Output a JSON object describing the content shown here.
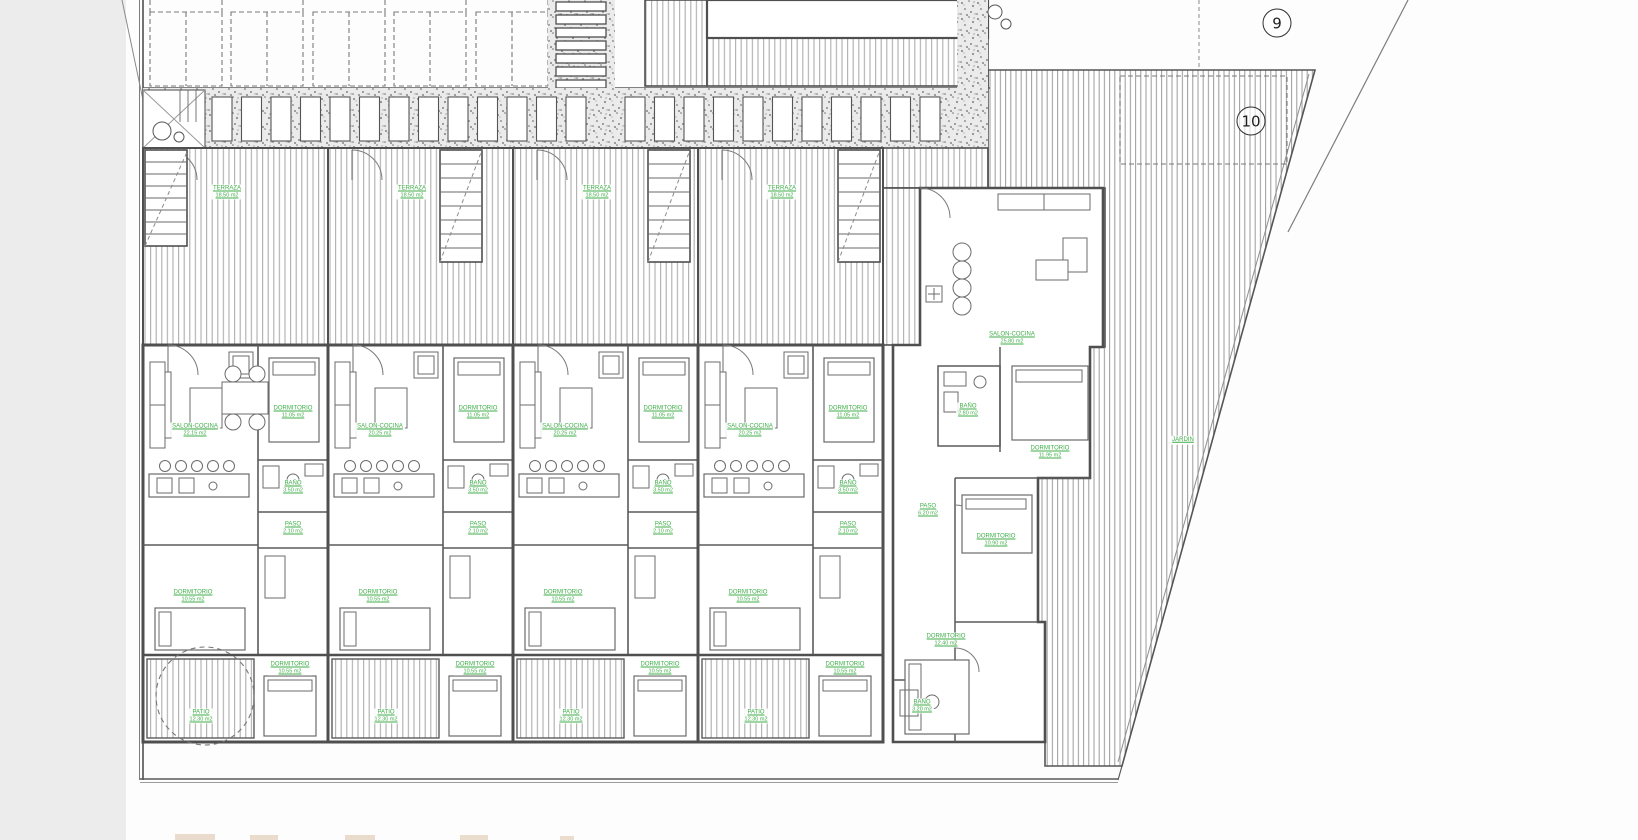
{
  "markers": {
    "nine": "9",
    "ten": "10"
  },
  "colors": {
    "label_green": "#3fae49",
    "wall": "#4f4f4f",
    "hatch": "#adadad"
  },
  "units": [
    {
      "terraza": {
        "name": "TERRAZA",
        "area": "18.50 m2"
      },
      "salon": {
        "name": "SALON-COCINA",
        "area": "22.15 m2"
      },
      "dormitorio_1": {
        "name": "DORMITORIO",
        "area": "11.05 m2"
      },
      "bano": {
        "name": "BAÑO",
        "area": "3.50 m2"
      },
      "paso": {
        "name": "PASO",
        "area": "2.10 m2"
      },
      "dormitorio_2": {
        "name": "DORMITORIO",
        "area": "10.55 m2"
      },
      "dormitorio_3": {
        "name": "DORMITORIO",
        "area": "10.55 m2"
      },
      "patio": {
        "name": "PATIO",
        "area": "12.30 m2"
      }
    },
    {
      "terraza": {
        "name": "TERRAZA",
        "area": "18.50 m2"
      },
      "salon": {
        "name": "SALON-COCINA",
        "area": "20.25 m2"
      },
      "dormitorio_1": {
        "name": "DORMITORIO",
        "area": "11.05 m2"
      },
      "bano": {
        "name": "BAÑO",
        "area": "3.50 m2"
      },
      "paso": {
        "name": "PASO",
        "area": "2.10 m2"
      },
      "dormitorio_2": {
        "name": "DORMITORIO",
        "area": "10.55 m2"
      },
      "dormitorio_3": {
        "name": "DORMITORIO",
        "area": "10.55 m2"
      },
      "patio": {
        "name": "PATIO",
        "area": "12.30 m2"
      }
    },
    {
      "terraza": {
        "name": "TERRAZA",
        "area": "18.50 m2"
      },
      "salon": {
        "name": "SALON-COCINA",
        "area": "20.25 m2"
      },
      "dormitorio_1": {
        "name": "DORMITORIO",
        "area": "11.05 m2"
      },
      "bano": {
        "name": "BAÑO",
        "area": "3.50 m2"
      },
      "paso": {
        "name": "PASO",
        "area": "2.10 m2"
      },
      "dormitorio_2": {
        "name": "DORMITORIO",
        "area": "10.55 m2"
      },
      "dormitorio_3": {
        "name": "DORMITORIO",
        "area": "10.55 m2"
      },
      "patio": {
        "name": "PATIO",
        "area": "12.30 m2"
      }
    },
    {
      "terraza": {
        "name": "TERRAZA",
        "area": "18.50 m2"
      },
      "salon": {
        "name": "SALON-COCINA",
        "area": "20.25 m2"
      },
      "dormitorio_1": {
        "name": "DORMITORIO",
        "area": "11.05 m2"
      },
      "bano": {
        "name": "BAÑO",
        "area": "3.50 m2"
      },
      "paso": {
        "name": "PASO",
        "area": "2.10 m2"
      },
      "dormitorio_2": {
        "name": "DORMITORIO",
        "area": "10.55 m2"
      },
      "dormitorio_3": {
        "name": "DORMITORIO",
        "area": "10.55 m2"
      },
      "patio": {
        "name": "PATIO",
        "area": "12.30 m2"
      }
    }
  ],
  "corner_unit": {
    "salon": {
      "name": "SALON-COCINA",
      "area": "25.80 m2"
    },
    "bano_1": {
      "name": "BAÑO",
      "area": "2.80 m2"
    },
    "dormitorio_1": {
      "name": "DORMITORIO",
      "area": "11.95 m2"
    },
    "paso": {
      "name": "PASO",
      "area": "6.20 m2"
    },
    "dormitorio_2": {
      "name": "DORMITORIO",
      "area": "10.90 m2"
    },
    "dormitorio_3": {
      "name": "DORMITORIO",
      "area": "12.40 m2"
    },
    "bano_2": {
      "name": "BAÑO",
      "area": "3.20 m2"
    }
  },
  "garden": {
    "label": {
      "name": "JARDIN",
      "area": ""
    }
  }
}
